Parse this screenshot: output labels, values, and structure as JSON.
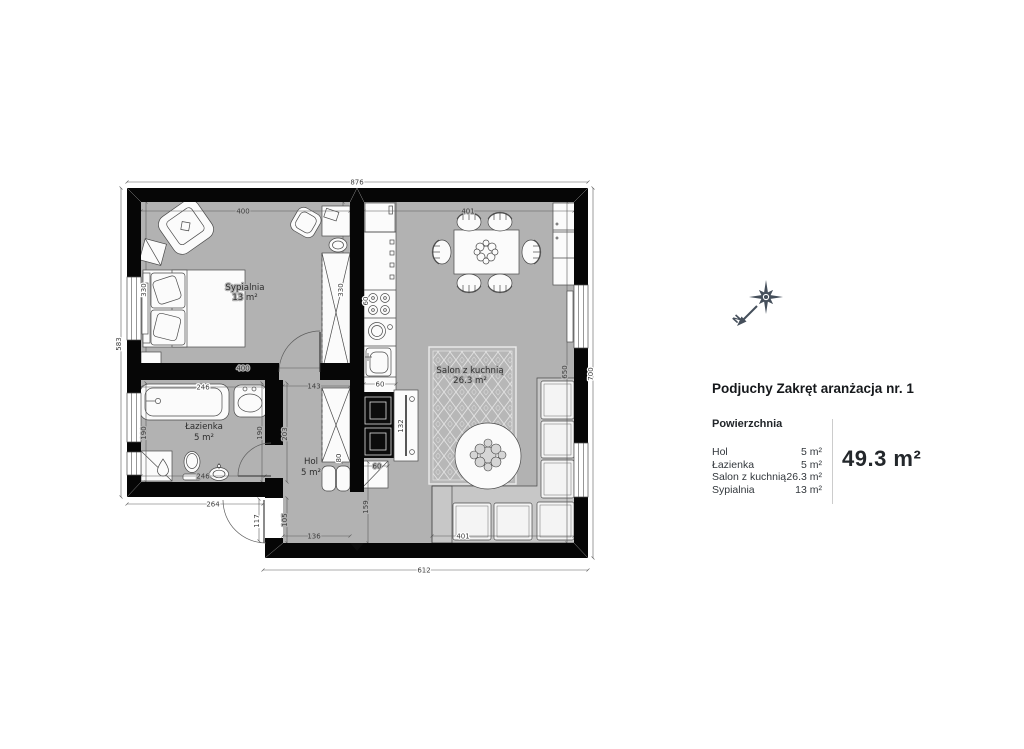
{
  "title": "Podjuchy Zakręt aranżacja nr. 1",
  "panel": {
    "section_label": "Powierzchnia",
    "rows": [
      {
        "label": "Hol",
        "value": "5 m²"
      },
      {
        "label": "Łazienka",
        "value": "5 m²"
      },
      {
        "label": "Salon z kuchnią",
        "value": "26.3 m²"
      },
      {
        "label": "Sypialnia",
        "value": "13 m²"
      }
    ],
    "total": "49.3 m²"
  },
  "compass": {
    "north": "N",
    "color": "#454f5b"
  },
  "rooms": {
    "sypialnia": {
      "name": "Sypialnia",
      "area": "13 m²"
    },
    "lazienka": {
      "name": "Łazienka",
      "area": "5 m²"
    },
    "hol": {
      "name": "Hol",
      "area": "5 m²"
    },
    "salon": {
      "name": "Salon z kuchnią",
      "area": "26.3 m²"
    }
  },
  "dims": {
    "d876": "876",
    "d583": "583",
    "d700": "700",
    "d612": "612",
    "d650": "650",
    "d264": "264",
    "syp_w_top": "400",
    "syp_w_bot": "400",
    "salon_w_top": "401",
    "salon_w_bot": "401",
    "bath_w_top": "246",
    "bath_w_bot": "246",
    "bath_h_l": "190",
    "bath_h_r": "190",
    "hol_w_top": "143",
    "hol_h": "203",
    "entry_h": "105",
    "door_w": "117",
    "hol_w_bot": "136",
    "sofa_clear": "159",
    "shoe_w": "60",
    "counter_d": "60",
    "hob_w": "60",
    "syp_h": "330",
    "wardrobe_h": "330",
    "table_l": "132",
    "wardrobe_w": "80"
  },
  "colors": {
    "floor": "#b2b2b2",
    "wall": "#060606",
    "sofa_base": "#c7c7c7",
    "accent_dark": "#0c0c0c"
  }
}
